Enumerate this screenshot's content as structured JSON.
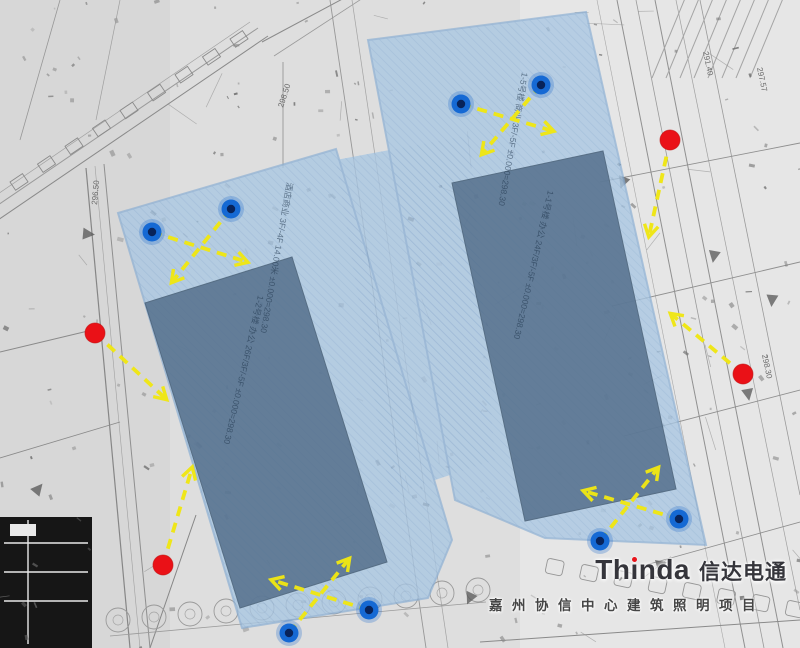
{
  "logo": {
    "name": "Thinda",
    "name_pre": "Th",
    "name_post": "nda",
    "name_cn": "信达电通",
    "project": "嘉州协信中心建筑照明项目",
    "accent_red": "#e8141b"
  },
  "colors": {
    "background_gray": "#dedede",
    "overlay_light_blue": "#a9c7e3",
    "overlay_hatch": "#7fa6cd",
    "overlay_edge": "#86abd2",
    "building_mass": "#4f6a87",
    "arrow_yellow": "#f0e713",
    "marker_red": "#ea1117",
    "marker_blue_ring": "#1569d4",
    "marker_blue_core": "#08235a",
    "linework_gray": "#8f8f8f"
  },
  "overlay": {
    "left_wing": [
      [
        118,
        213
      ],
      [
        336,
        149
      ],
      [
        452,
        540
      ],
      [
        428,
        598
      ],
      [
        242,
        628
      ]
    ],
    "bridge": [
      [
        336,
        160
      ],
      [
        470,
        135
      ],
      [
        495,
        460
      ],
      [
        390,
        495
      ]
    ],
    "right_wing": [
      [
        368,
        40
      ],
      [
        586,
        12
      ],
      [
        706,
        545
      ],
      [
        545,
        538
      ],
      [
        455,
        500
      ]
    ],
    "buildings": {
      "left": [
        [
          145,
          303
        ],
        [
          292,
          257
        ],
        [
          387,
          562
        ],
        [
          240,
          608
        ]
      ],
      "right": [
        [
          452,
          183
        ],
        [
          603,
          151
        ],
        [
          676,
          489
        ],
        [
          525,
          521
        ]
      ]
    }
  },
  "markers": {
    "blue": [
      {
        "x": 152,
        "y": 232
      },
      {
        "x": 231,
        "y": 209
      },
      {
        "x": 461,
        "y": 104
      },
      {
        "x": 541,
        "y": 85
      },
      {
        "x": 289,
        "y": 633
      },
      {
        "x": 369,
        "y": 610
      },
      {
        "x": 600,
        "y": 541
      },
      {
        "x": 679,
        "y": 519
      }
    ],
    "red": [
      {
        "x": 95,
        "y": 333
      },
      {
        "x": 163,
        "y": 565
      },
      {
        "x": 670,
        "y": 140
      },
      {
        "x": 743,
        "y": 374
      }
    ]
  },
  "arrows": [
    {
      "from": [
        152,
        232
      ],
      "to": [
        247,
        262
      ]
    },
    {
      "from": [
        231,
        209
      ],
      "to": [
        172,
        282
      ]
    },
    {
      "from": [
        461,
        104
      ],
      "to": [
        553,
        131
      ]
    },
    {
      "from": [
        541,
        85
      ],
      "to": [
        482,
        154
      ]
    },
    {
      "from": [
        289,
        633
      ],
      "to": [
        349,
        559
      ]
    },
    {
      "from": [
        369,
        610
      ],
      "to": [
        272,
        580
      ]
    },
    {
      "from": [
        600,
        541
      ],
      "to": [
        658,
        468
      ]
    },
    {
      "from": [
        679,
        519
      ],
      "to": [
        584,
        491
      ]
    },
    {
      "from": [
        95,
        333
      ],
      "to": [
        166,
        399
      ]
    },
    {
      "from": [
        163,
        565
      ],
      "to": [
        192,
        468
      ]
    },
    {
      "from": [
        670,
        140
      ],
      "to": [
        649,
        236
      ]
    },
    {
      "from": [
        743,
        374
      ],
      "to": [
        671,
        314
      ]
    }
  ],
  "plan_labels": {
    "building_annotations": [
      {
        "text": "1-2号楼 办公 26F/3F/-5F ±0.000=298.30",
        "x": 258,
        "y": 295,
        "rot": 103
      },
      {
        "text": "1-1号楼 办公 24F/3F/-5F ±0.000=298.30",
        "x": 548,
        "y": 190,
        "rot": 103
      },
      {
        "text": "1-5号楼 商业 3F/-5F ±0.000=298.30",
        "x": 522,
        "y": 72,
        "rot": 100
      },
      {
        "text": "酒店商业 3F/-4F 14.00米 ±0.000=298.30",
        "x": 287,
        "y": 182,
        "rot": 100
      }
    ],
    "elevations": [
      {
        "text": "297.57",
        "x": 757,
        "y": 68,
        "rot": 78
      },
      {
        "text": "291.40",
        "x": 703,
        "y": 52,
        "rot": 78
      },
      {
        "text": "298.30",
        "x": 762,
        "y": 355,
        "rot": 78
      },
      {
        "text": "298.50",
        "x": 283,
        "y": 108,
        "rot": -72
      },
      {
        "text": "296.50",
        "x": 97,
        "y": 205,
        "rot": -85
      }
    ]
  }
}
